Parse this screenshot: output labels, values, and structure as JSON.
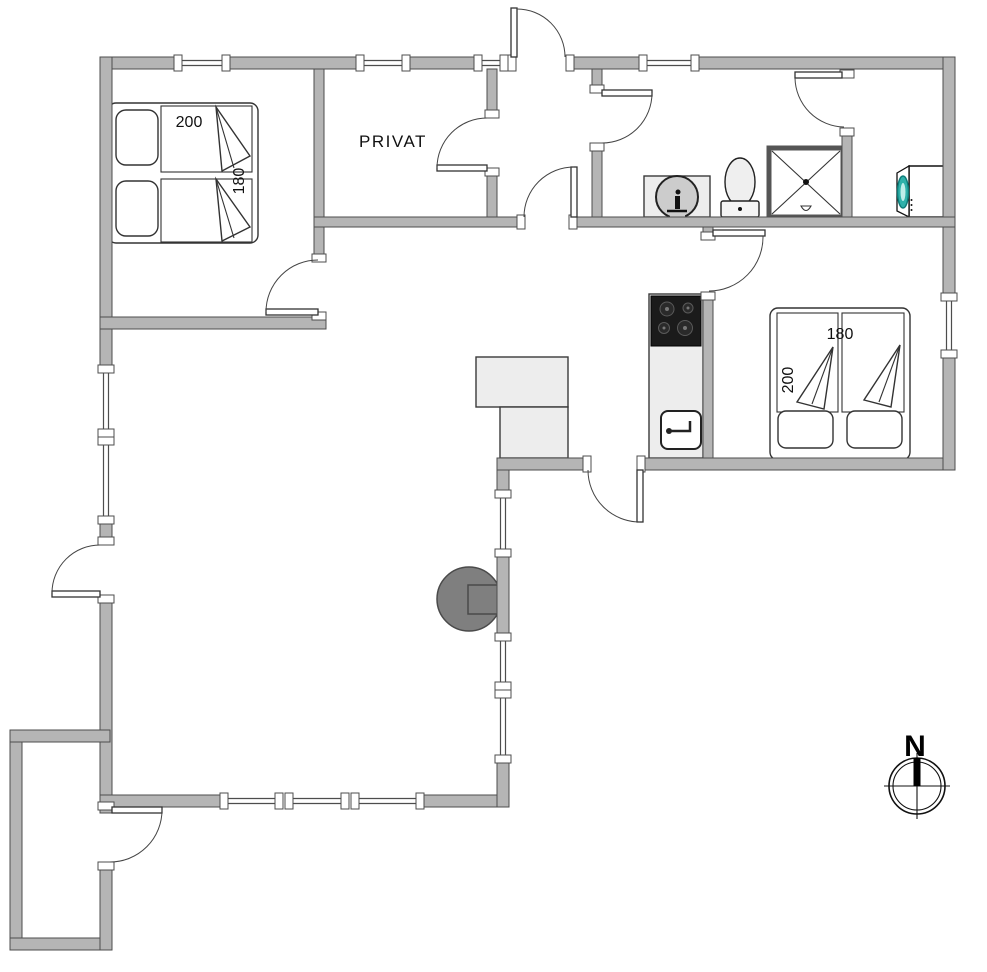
{
  "plan": {
    "room_label": "PRIVAT",
    "compass_north": "N",
    "bed_top_left": {
      "width_cm": "200",
      "length_cm": "180"
    },
    "bed_right": {
      "width_cm": "180",
      "length_cm": "200"
    }
  },
  "colors": {
    "wall_fill": "#b5b5b5",
    "wall_outline": "#4d4d4d",
    "counter_fill": "#ededed",
    "cooktop_black": "#1b1b1b",
    "wood_stove_gray": "#7f7f7f",
    "washer_door_teal": "#2fb1aa",
    "background": "#ffffff"
  }
}
